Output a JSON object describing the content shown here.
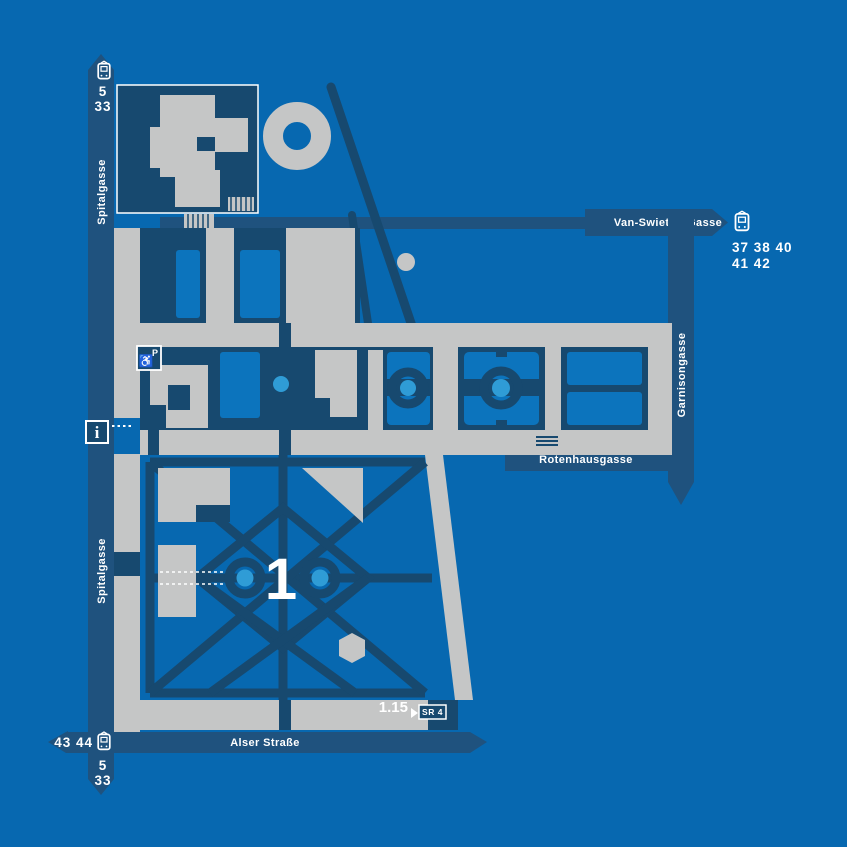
{
  "colors": {
    "background": "#0768B0",
    "ribbon": "#1F527E",
    "path_navy": "#17496F",
    "building_gray": "#C5C6C6",
    "lawn_blue": "#0C74BD",
    "fountain_blue": "#2F9CD6",
    "label_white": "#FFFFFF"
  },
  "streets": {
    "spitalgasse": {
      "label": "Spitalgasse"
    },
    "van_swieten_gasse": {
      "label": "Van-Swieten-Gasse"
    },
    "garnisongasse": {
      "label": "Garnisongasse"
    },
    "rotenhausgasse": {
      "label": "Rotenhausgasse"
    },
    "alser_strasse": {
      "label": "Alser Straße"
    }
  },
  "tram_stops": {
    "spitalgasse_top": {
      "line_row1": "5",
      "line_row2": "33"
    },
    "van_swieten": {
      "line_row1": "37 38 40",
      "line_row2": "41 42"
    },
    "alser_spitalgasse": {
      "lines_left": "43 44",
      "line_row1": "5",
      "line_row2": "33"
    }
  },
  "courtyard": {
    "number": "1"
  },
  "room": {
    "code": "1.15",
    "badge": "SR 4"
  },
  "icons": {
    "info": "i",
    "parking": "P",
    "wheelchair": "♿"
  }
}
